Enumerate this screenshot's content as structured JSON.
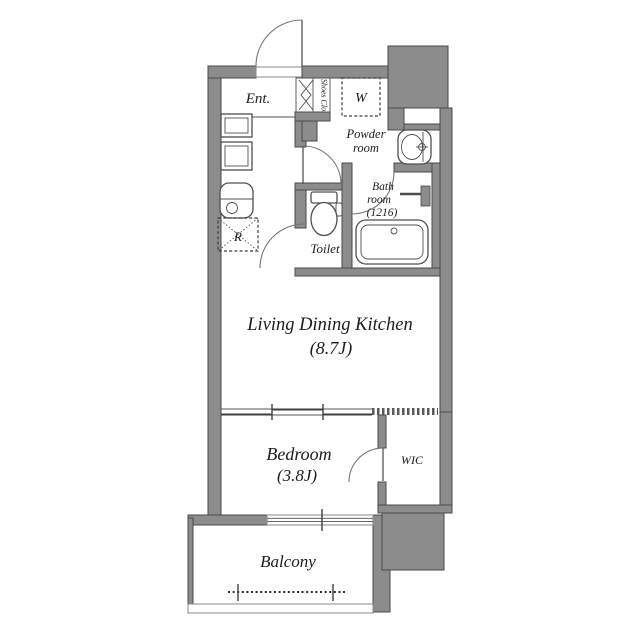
{
  "colors": {
    "wall_fill": "#8c8c8c",
    "wall_stroke": "#4a4a4a",
    "fixture_line": "#4f4f4f",
    "text": "#1c1c1c",
    "floor": "#ffffff"
  },
  "rooms": {
    "entrance": {
      "label": "Ent."
    },
    "shoes_closet": {
      "label": "Shoes Clo"
    },
    "washing_machine": {
      "label": "W"
    },
    "powder_room": {
      "line1": "Powder",
      "line2": "room"
    },
    "bathroom": {
      "line1": "Bath",
      "line2": "room",
      "line3": "(1216)"
    },
    "toilet": {
      "label": "Toilet"
    },
    "refrigerator": {
      "label": "R"
    },
    "living_dining_kitchen": {
      "label": "Living Dining Kitchen",
      "area": "(8.7J)"
    },
    "bedroom": {
      "label": "Bedroom",
      "area": "(3.8J)"
    },
    "walk_in_closet": {
      "label": "WIC"
    },
    "balcony": {
      "label": "Balcony"
    }
  }
}
